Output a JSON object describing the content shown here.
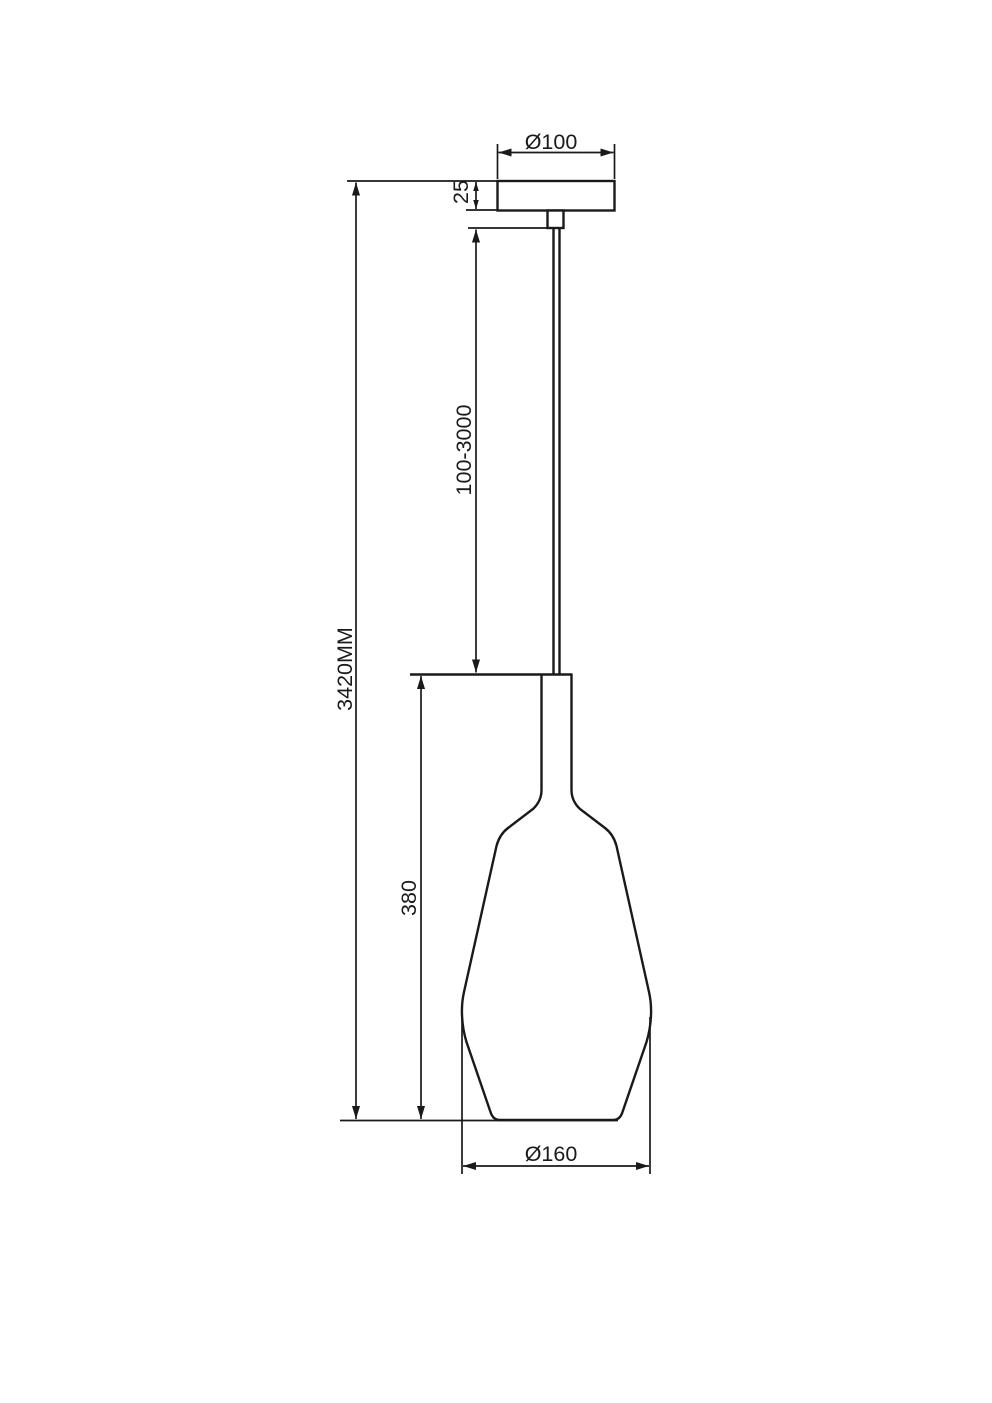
{
  "drawing": {
    "background": "#ffffff",
    "line_color": "#1a1a1a",
    "labels": {
      "canopy_diameter": "Ø100",
      "canopy_height": "25",
      "suspension_length": "100-3000",
      "overall_height": "3420MM",
      "shade_height": "380",
      "shade_diameter": "Ø160"
    }
  }
}
